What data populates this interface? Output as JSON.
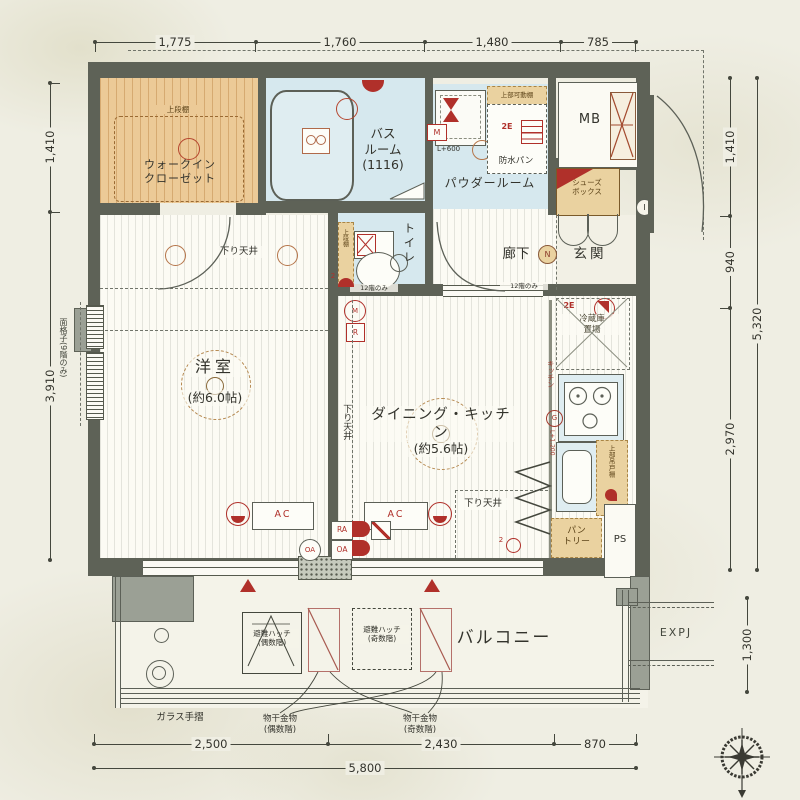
{
  "dims": {
    "top": [
      "1,775",
      "1,760",
      "1,480",
      "785"
    ],
    "bottom": [
      "2,500",
      "2,430",
      "870"
    ],
    "bottom_total": "5,800",
    "left_top": "1,410",
    "left_mid": "3,910",
    "left_note": "面格子(9階のみ)",
    "right_1": "1,410",
    "right_2": "940",
    "right_3": "2,970",
    "right_total": "5,320",
    "right_balcony": "1,300"
  },
  "rooms": {
    "wic": {
      "name": "ウォークイン\nクローゼット",
      "shelf": "上段棚"
    },
    "bath": {
      "name": "バス\nルーム\n(1116)"
    },
    "powder": {
      "name": "パウダールーム",
      "pan": "防水パン",
      "top_shelf": "上部可動棚",
      "outlet": "2E",
      "meter": "M",
      "level": "L+600"
    },
    "mb": {
      "name": "MB"
    },
    "shoes": {
      "name": "シューズ\nボックス"
    },
    "toilet": {
      "name": "トイレ",
      "shelf": "上段棚",
      "note": "12階のみ"
    },
    "hall": {
      "name": "廊下",
      "mark": "N"
    },
    "genkan": {
      "name": "玄関",
      "mark": "I"
    },
    "west": {
      "name": "洋室",
      "size": "(約6.0帖)"
    },
    "dk": {
      "name": "ダイニング・キッチン",
      "size": "(約5.6帖)"
    },
    "kitchen": {
      "label": "キッチン",
      "mark": "G",
      "fridge": "冷蔵庫\n置場",
      "outlet": "2E",
      "level": "L+1,200",
      "cabinet": "上部吊戸棚",
      "pantry": "パン\nトリー",
      "ps": "PS"
    }
  },
  "notes": {
    "lowered_ceiling": "下り天井",
    "ac": "AC",
    "ra": "RA",
    "oa": "OA",
    "r": "R",
    "m": "M",
    "qty": "2"
  },
  "balcony": {
    "name": "バルコニー",
    "hatch_even": "避難ハッチ\n(偶数階)",
    "hatch_odd": "避難ハッチ\n(奇数階)",
    "laundry_even": "物干金物\n(偶数階)",
    "laundry_odd": "物干金物\n(奇数階)",
    "glass_rail": "ガラス手摺",
    "expj": "EXPJ"
  }
}
